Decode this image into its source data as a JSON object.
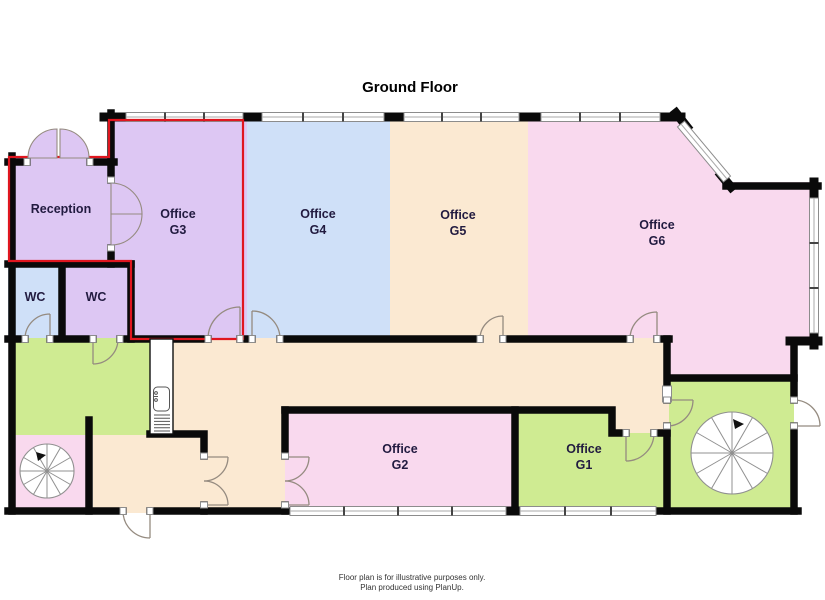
{
  "title": "Ground Floor",
  "footer": {
    "line1": "Floor plan is for illustrative purposes only.",
    "line2": "Plan produced using PlanUp."
  },
  "palette": {
    "wall": "#0a0a0a",
    "outline_red": "#e0161f",
    "window_frame": "#8c8c8c",
    "door_arc": "#958b80",
    "label": "#221b40",
    "title_color": "#000000",
    "footer_color": "#333333"
  },
  "rooms": {
    "reception": {
      "name": "Reception",
      "color": "#ddc7f3"
    },
    "wc_left": {
      "name": "WC",
      "color": "#cfe0f8"
    },
    "wc_right": {
      "name": "WC",
      "color": "#ddc7f3"
    },
    "office_g3": {
      "line1": "Office",
      "line2": "G3",
      "color": "#ddc7f3"
    },
    "office_g4": {
      "line1": "Office",
      "line2": "G4",
      "color": "#cfe0f8"
    },
    "office_g5": {
      "line1": "Office",
      "line2": "G5",
      "color": "#fbe9d2"
    },
    "office_g6": {
      "line1": "Office",
      "line2": "G6",
      "color": "#f9d9ee"
    },
    "office_g2": {
      "line1": "Office",
      "line2": "G2",
      "color": "#f9d9ee"
    },
    "office_g1": {
      "line1": "Office",
      "line2": "G1",
      "color": "#cfeb92"
    },
    "corridor": {
      "color": "#fbe9d2"
    },
    "kitchen": {
      "color": "#cfeb92"
    },
    "stair_room_left": {
      "color": "#f9d9ee"
    },
    "stair_room_right": {
      "color": "#cfeb92"
    }
  }
}
